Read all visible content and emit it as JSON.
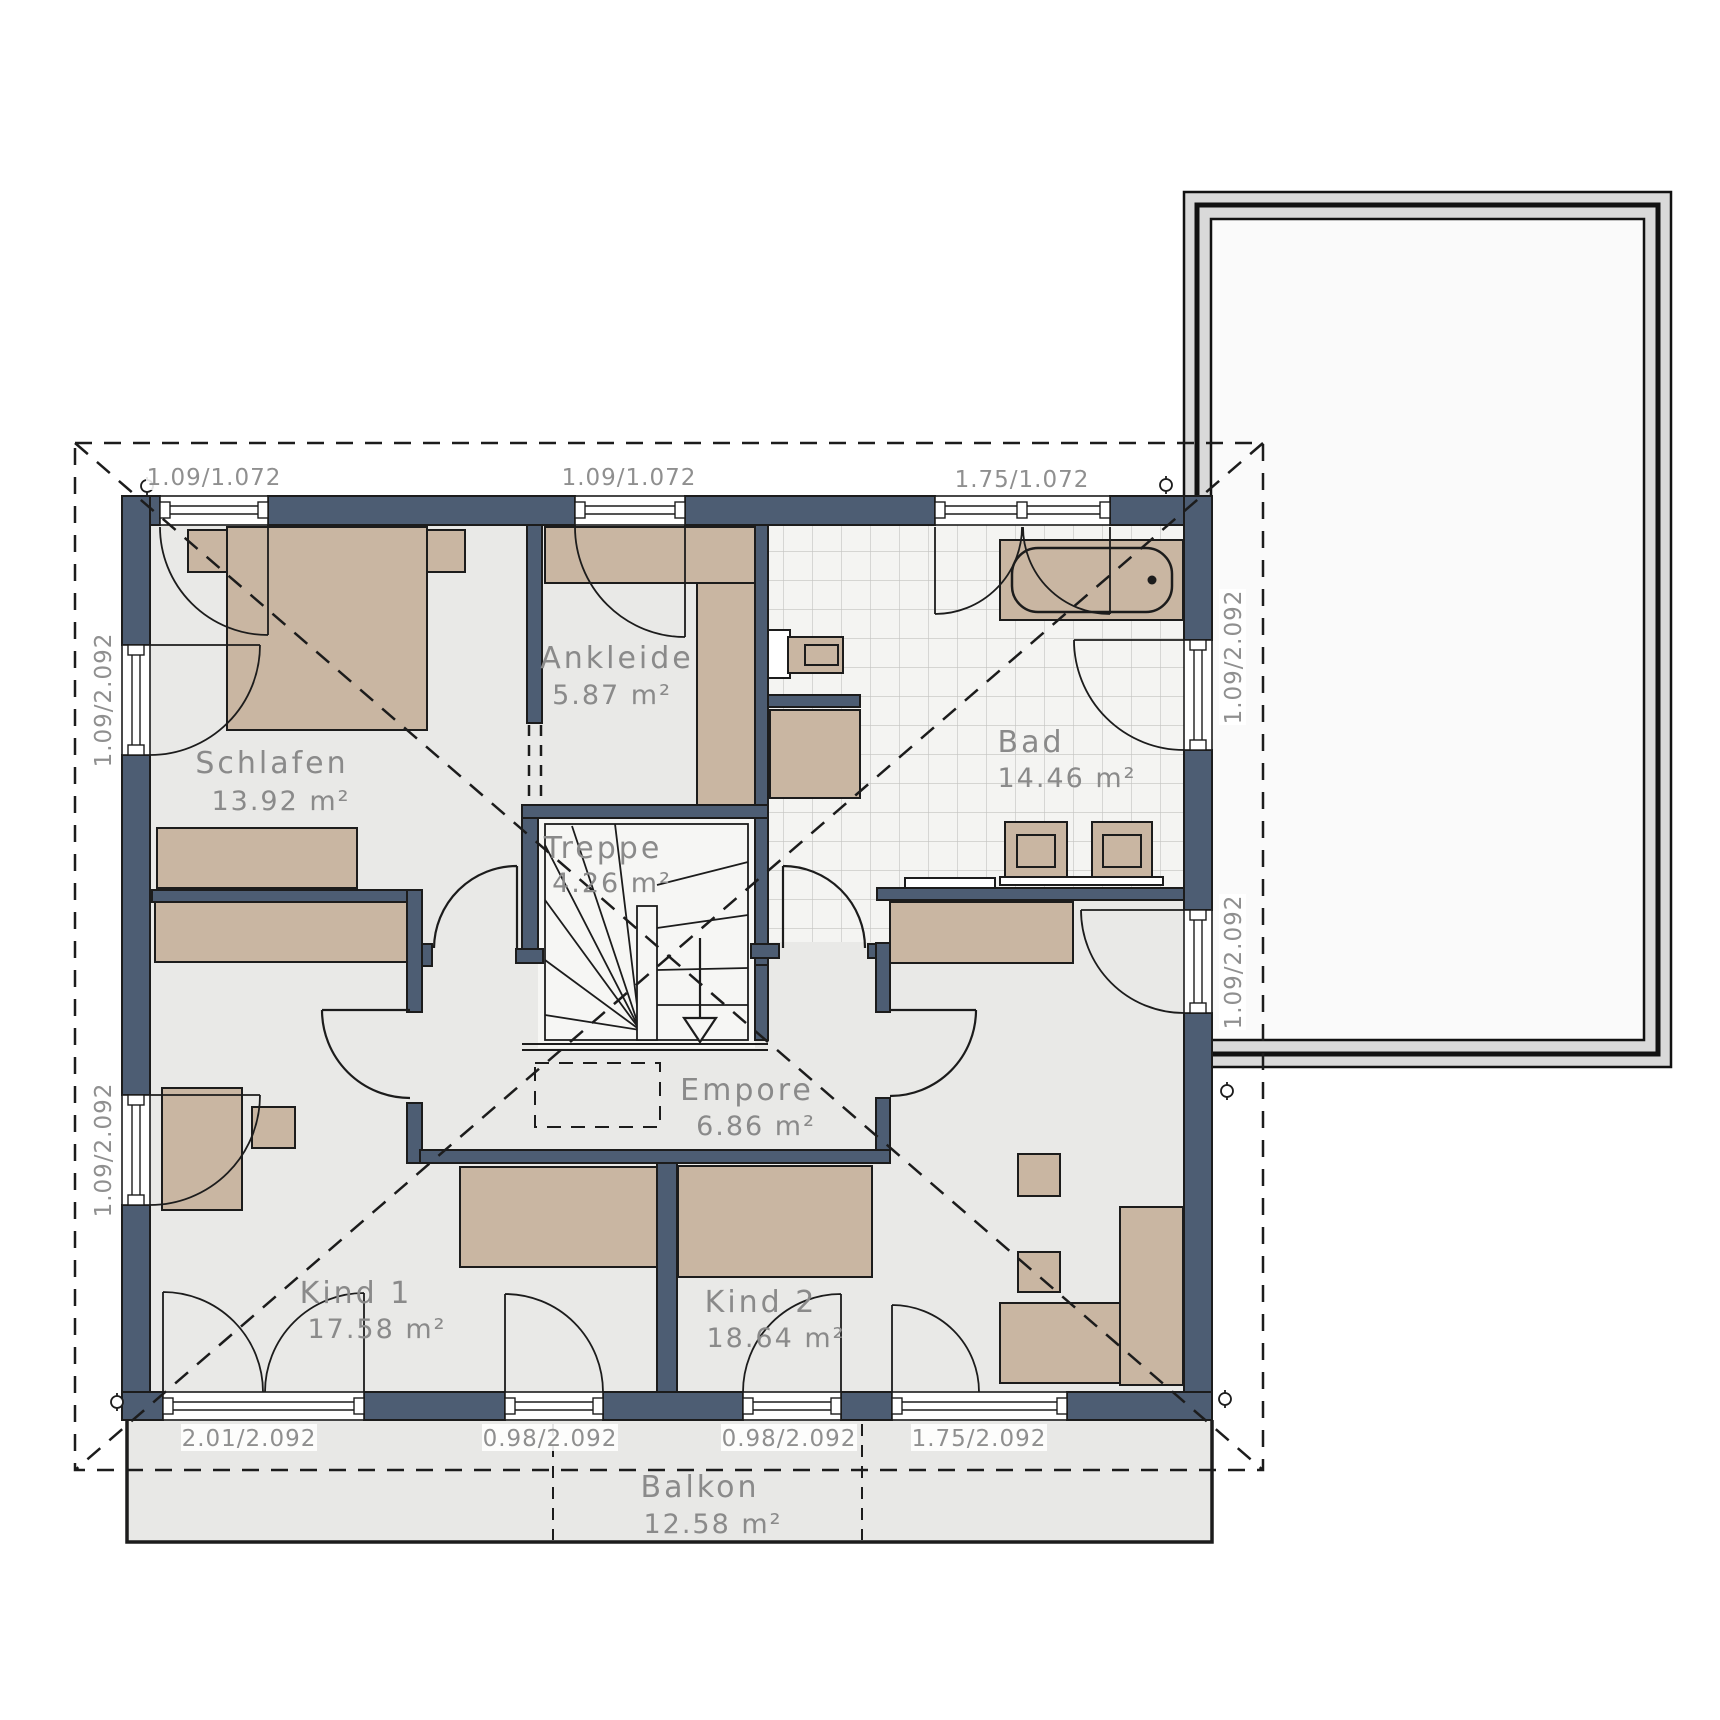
{
  "plan": {
    "title": "Obergeschoss Grundriss",
    "rooms": [
      {
        "id": "schlafen",
        "name": "Schlafen",
        "area": "13.92 m²"
      },
      {
        "id": "ankleide",
        "name": "Ankleide",
        "area": "5.87 m²"
      },
      {
        "id": "bad",
        "name": "Bad",
        "area": "14.46 m²"
      },
      {
        "id": "treppe",
        "name": "Treppe",
        "area": "4.26 m²"
      },
      {
        "id": "empore",
        "name": "Empore",
        "area": "6.86 m²"
      },
      {
        "id": "kind1",
        "name": "Kind 1",
        "area": "17.58 m²"
      },
      {
        "id": "kind2",
        "name": "Kind 2",
        "area": "18.64 m²"
      },
      {
        "id": "balkon",
        "name": "Balkon",
        "area": "12.58 m²"
      }
    ],
    "dimensions": {
      "top": [
        "1.09/1.072",
        "1.09/1.072",
        "1.75/1.072"
      ],
      "bottom": [
        "2.01/2.092",
        "0.98/2.092",
        "0.98/2.092",
        "1.75/2.092"
      ],
      "left": [
        "1.09/2.092",
        "1.09/2.092"
      ],
      "right": [
        "1.09/2.092",
        "1.09/2.092"
      ]
    },
    "colors": {
      "wall": "#4d5d73",
      "furniture": "#c9b6a2",
      "floor": "#e9e9e7",
      "tile_floor": "#f4f4f2",
      "stair_floor": "#f6f6f4",
      "terrace": "#e8e8e6",
      "roof_deck": "#fafafa",
      "frame_gray": "#d9d9d9",
      "line": "#1c1c1c",
      "label": "#8a8a8a"
    }
  }
}
